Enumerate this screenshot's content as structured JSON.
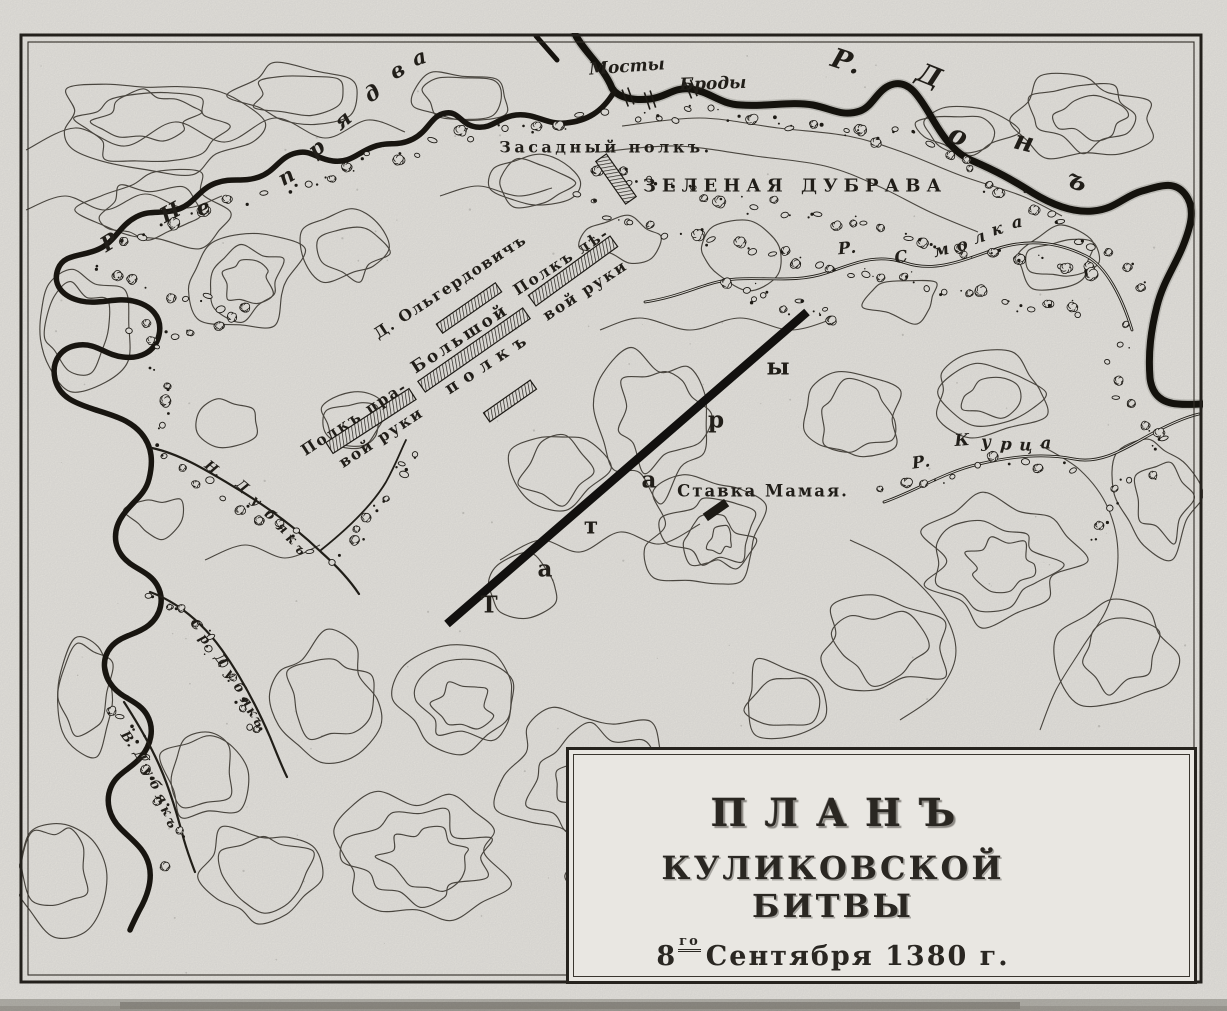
{
  "map": {
    "title_cartouche": {
      "line1": "ПЛАНЪ",
      "line2": "КУЛИКОВСКОЙ БИТВЫ",
      "date_day": "8",
      "date_ordinal": "го",
      "date_rest": "Сентября 1380 г."
    },
    "labels": {
      "bridges": "Мосты",
      "fords": "Броды",
      "ambush_regiment": "Засадный полкъ.",
      "green_grove": "ЗЕЛЕНАЯ ДУБРАВА",
      "olgerdovich": "Д. Ольгердовичъ",
      "big_regiment_line1": "Большой",
      "big_regiment_line2": "полкъ",
      "left_hand_line1": "Полкъ лѣ-",
      "left_hand_line2": "вой руки",
      "right_hand_line1": "Полкъ пра-",
      "right_hand_line2": "вой руки",
      "mamai_hq": "Ставка Мамая.",
      "tatars": "Татары",
      "river_don": "Р. Донъ",
      "river_nepryadva": "Р. Непрядва",
      "river_smolka": "Р. Смолка",
      "river_kurtsa": "Р. Курца",
      "stream_n_dubyak": "Н. Дубякъ",
      "stream_sr_dubyak": "Ср. Дубякъ",
      "stream_v_dubyak": "В. Дубякъ"
    },
    "colors": {
      "paper": "#e6e4df",
      "ink": "#1f1c17",
      "contour": "#4e4a43"
    }
  }
}
